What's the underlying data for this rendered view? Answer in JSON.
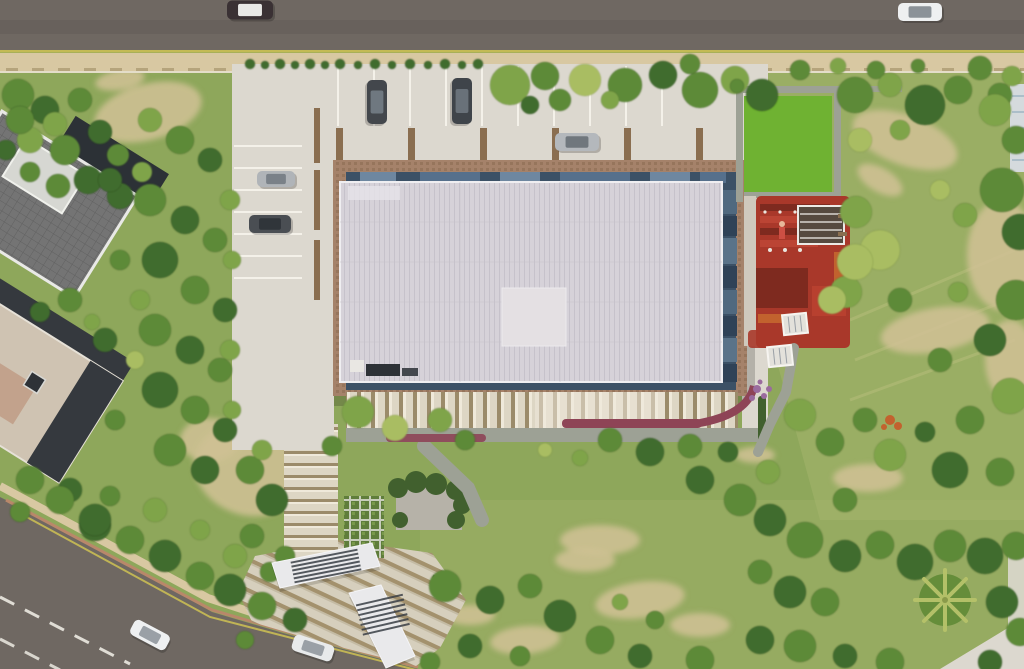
{
  "scene": {
    "view": "top-down aerial 3D architectural rendering of a site plan",
    "site": {
      "main_building": "rectangular hall with translucent ribbed light roof, dark blue glass clerestory and terracotta paved apron band",
      "parking": "stall rows north and west of the building with planter dividers",
      "playground": "red, maroon and orange play area east of the building beside a bright lawn",
      "entrance": "striped pedestrian axis with two white angular canopies at the south-west"
    },
    "roads": {
      "north": "straight asphalt road across full width with tan dashed sidewalk",
      "south_west": "diagonal asphalt road with dashed white centerline and yellow edge line"
    },
    "neighbors": [
      "dark gridded flat-roof building (north-west)",
      "beige flat-roof building (west)",
      "building corner at the east edge"
    ],
    "vegetation": [
      "street shrub row",
      "dense tree belts",
      "bright green lawn",
      "dry meadow with dirt patches",
      "palm tree (south-east)"
    ],
    "vehicle_count": 9
  },
  "colors": {
    "grass_base": "#8ea75b",
    "grass_light": "#a6b56d",
    "grass_pale": "#bcc17e",
    "lawn_green": "#6fb232",
    "dirt": "#cfc094",
    "gravel": "#b6b2a8",
    "road_asphalt": "#6f6862",
    "road_line_yellow": "#c9bd54",
    "road_line_white": "#eceae2",
    "curb_red": "#b9886a",
    "sidewalk_tan": "#d8c8a2",
    "sidewalk_dash": "#b5a47c",
    "pavement": "#dcd8cf",
    "pavement_line": "#f4f1e9",
    "planter_brown": "#8a6e50",
    "path_gray": "#9da195",
    "building_band": "#a5826a",
    "glass_dark": "#3c5166",
    "glass_light": "#6e87a0",
    "glass_mid": "#56708c",
    "glass_panel_a": "#50697f",
    "glass_panel_b": "#2f4257",
    "glass_panel_c": "#5a7389",
    "roof_light": "#d6d2d9",
    "roof_stripe": "#c6c2cb",
    "roof_patch": "#e4e0e3",
    "roof_edge": "#efeef1",
    "pergola_cream": "#ddd6c4",
    "pergola_brown": "#9b8b6a",
    "pergola_white": "#efe9da",
    "plaza_cream": "#d6cfbd",
    "plaza_brown": "#a3916d",
    "plaza_light": "#c4bba4",
    "tree_dark": "#406c2e",
    "tree_mid": "#5d8a38",
    "tree_light": "#7fa44a",
    "tree_pale": "#a9bd62",
    "hedge_dark": "#41602e",
    "play_red": "#a9382a",
    "play_maroon": "#7e2a1f",
    "play_orange": "#c2622e",
    "play_red_bright": "#bb4434",
    "canopy_white": "#e9e9eb",
    "canopy_louver": "#3a3f46",
    "flower_purple": "#9a6b9e",
    "flower_red": "#8e4456",
    "roofA_gray": "#747474",
    "roofA_line": "#616161",
    "roofA_dark": "#2c3136",
    "roofA_edge": "#e9e9e6",
    "roofB_beige": "#cfc3b2",
    "roofB_dark": "#35393e",
    "roofB_pink": "#c2a28c",
    "neighbor_wall": "#d5dadd",
    "neighbor_edge": "#edeff0",
    "car_window": "#8b9298"
  },
  "vehicles": [
    {
      "name": "top-road-car-dark",
      "x": 250,
      "y": 10,
      "len": 46,
      "wid": 19,
      "angle": 0,
      "body": "#3a3134",
      "glass": "#e8e8e6"
    },
    {
      "name": "top-road-car-white",
      "x": 920,
      "y": 12,
      "len": 44,
      "wid": 18,
      "angle": 0,
      "body": "#eef0f1",
      "glass": "#8b9298"
    },
    {
      "name": "parking-car-dark-1",
      "x": 377,
      "y": 102,
      "len": 44,
      "wid": 20,
      "angle": 90,
      "body": "#43474c",
      "glass": "#6f7880"
    },
    {
      "name": "parking-car-dark-2",
      "x": 462,
      "y": 101,
      "len": 46,
      "wid": 20,
      "angle": 90,
      "body": "#3f444a",
      "glass": "#697179"
    },
    {
      "name": "parking-car-silver-1",
      "x": 577,
      "y": 142,
      "len": 44,
      "wid": 18,
      "angle": 0,
      "body": "#b4b8bc",
      "glass": "#70777d"
    },
    {
      "name": "parking-car-silver-2",
      "x": 276,
      "y": 179,
      "len": 38,
      "wid": 16,
      "angle": 0,
      "body": "#b0b4b8",
      "glass": "#7a8188"
    },
    {
      "name": "parking-car-dark-3",
      "x": 270,
      "y": 224,
      "len": 42,
      "wid": 18,
      "angle": 0,
      "body": "#4a4e53",
      "glass": "#30353a"
    },
    {
      "name": "bottom-road-car-white-1",
      "x": 150,
      "y": 635,
      "len": 40,
      "wid": 17,
      "angle": 28,
      "body": "#eef0f1",
      "glass": "#9aa0a6"
    },
    {
      "name": "bottom-road-car-white-2",
      "x": 313,
      "y": 648,
      "len": 42,
      "wid": 17,
      "angle": 18,
      "body": "#e8eaeb",
      "glass": "#9aa0a6"
    }
  ],
  "landscape": {
    "dirt_patches": [
      [
        148,
        112,
        55,
        28,
        -15
      ],
      [
        120,
        80,
        25,
        10,
        -10
      ],
      [
        248,
        470,
        55,
        45,
        20
      ],
      [
        210,
        440,
        30,
        22,
        0
      ],
      [
        905,
        140,
        55,
        25,
        20
      ],
      [
        1002,
        255,
        35,
        55,
        0
      ],
      [
        935,
        330,
        55,
        22,
        -10
      ],
      [
        868,
        478,
        35,
        14,
        0
      ],
      [
        1010,
        360,
        25,
        40,
        0
      ],
      [
        880,
        180,
        25,
        12,
        30
      ],
      [
        640,
        600,
        45,
        18,
        -8
      ],
      [
        525,
        640,
        35,
        14,
        -5
      ],
      [
        470,
        615,
        25,
        10,
        0
      ],
      [
        700,
        625,
        30,
        12,
        0
      ],
      [
        600,
        540,
        40,
        15,
        0
      ],
      [
        585,
        560,
        30,
        12,
        0
      ],
      [
        755,
        455,
        20,
        8,
        0
      ]
    ],
    "trees": [
      [
        18,
        95,
        16,
        2
      ],
      [
        45,
        110,
        14,
        1
      ],
      [
        80,
        100,
        12,
        2
      ],
      [
        30,
        140,
        13,
        3
      ],
      [
        65,
        150,
        15,
        2
      ],
      [
        100,
        132,
        12,
        1
      ],
      [
        118,
        155,
        11,
        2
      ],
      [
        88,
        180,
        14,
        1
      ],
      [
        58,
        186,
        12,
        2
      ],
      [
        120,
        196,
        13,
        1
      ],
      [
        142,
        172,
        10,
        3
      ],
      [
        30,
        172,
        10,
        2
      ],
      [
        20,
        120,
        14,
        2
      ],
      [
        55,
        124,
        12,
        3
      ],
      [
        6,
        150,
        10,
        1
      ],
      [
        150,
        120,
        12,
        3
      ],
      [
        180,
        140,
        14,
        2
      ],
      [
        210,
        160,
        12,
        1
      ],
      [
        150,
        200,
        16,
        2
      ],
      [
        185,
        220,
        14,
        1
      ],
      [
        215,
        240,
        12,
        2
      ],
      [
        160,
        260,
        18,
        1
      ],
      [
        195,
        290,
        14,
        2
      ],
      [
        225,
        310,
        12,
        1
      ],
      [
        155,
        330,
        16,
        2
      ],
      [
        190,
        350,
        14,
        1
      ],
      [
        220,
        370,
        12,
        2
      ],
      [
        160,
        390,
        18,
        1
      ],
      [
        195,
        410,
        14,
        2
      ],
      [
        225,
        430,
        12,
        1
      ],
      [
        170,
        450,
        16,
        2
      ],
      [
        205,
        470,
        14,
        1
      ],
      [
        140,
        300,
        10,
        3
      ],
      [
        135,
        360,
        9,
        4
      ],
      [
        230,
        200,
        10,
        3
      ],
      [
        232,
        260,
        9,
        3
      ],
      [
        230,
        350,
        10,
        3
      ],
      [
        232,
        410,
        9,
        3
      ],
      [
        110,
        180,
        12,
        1
      ],
      [
        120,
        260,
        10,
        2
      ],
      [
        105,
        340,
        12,
        1
      ],
      [
        115,
        420,
        10,
        2
      ],
      [
        70,
        300,
        12,
        2
      ],
      [
        40,
        312,
        10,
        1
      ],
      [
        92,
        322,
        8,
        3
      ],
      [
        30,
        480,
        14,
        2
      ],
      [
        70,
        490,
        12,
        1
      ],
      [
        20,
        512,
        10,
        2
      ],
      [
        95,
        525,
        16,
        1
      ],
      [
        250,
        64,
        5,
        1
      ],
      [
        265,
        65,
        4,
        1
      ],
      [
        280,
        64,
        5,
        1
      ],
      [
        295,
        65,
        4,
        1
      ],
      [
        310,
        64,
        5,
        1
      ],
      [
        325,
        65,
        4,
        1
      ],
      [
        340,
        64,
        5,
        1
      ],
      [
        358,
        65,
        4,
        1
      ],
      [
        375,
        64,
        5,
        1
      ],
      [
        392,
        65,
        4,
        1
      ],
      [
        410,
        64,
        5,
        1
      ],
      [
        428,
        65,
        4,
        1
      ],
      [
        445,
        64,
        5,
        1
      ],
      [
        462,
        65,
        4,
        1
      ],
      [
        478,
        64,
        5,
        1
      ],
      [
        510,
        85,
        20,
        3
      ],
      [
        545,
        76,
        14,
        2
      ],
      [
        585,
        80,
        16,
        4
      ],
      [
        625,
        85,
        17,
        2
      ],
      [
        663,
        75,
        14,
        1
      ],
      [
        700,
        90,
        18,
        2
      ],
      [
        735,
        80,
        14,
        3
      ],
      [
        762,
        95,
        16,
        1
      ],
      [
        690,
        64,
        10,
        2
      ],
      [
        560,
        100,
        11,
        2
      ],
      [
        530,
        105,
        9,
        1
      ],
      [
        610,
        100,
        9,
        3
      ],
      [
        800,
        70,
        10,
        2
      ],
      [
        838,
        66,
        8,
        3
      ],
      [
        876,
        70,
        9,
        2
      ],
      [
        918,
        66,
        7,
        2
      ],
      [
        980,
        68,
        12,
        2
      ],
      [
        1012,
        76,
        10,
        3
      ],
      [
        1000,
        95,
        12,
        2
      ],
      [
        855,
        95,
        18,
        2
      ],
      [
        890,
        85,
        12,
        3
      ],
      [
        925,
        105,
        20,
        1
      ],
      [
        958,
        90,
        14,
        2
      ],
      [
        995,
        110,
        16,
        3
      ],
      [
        1016,
        140,
        14,
        2
      ],
      [
        860,
        140,
        12,
        4
      ],
      [
        900,
        130,
        10,
        3
      ],
      [
        1002,
        190,
        22,
        2
      ],
      [
        1020,
        232,
        18,
        1
      ],
      [
        965,
        215,
        12,
        3
      ],
      [
        940,
        190,
        10,
        4
      ],
      [
        856,
        212,
        16,
        3
      ],
      [
        880,
        250,
        20,
        4
      ],
      [
        846,
        292,
        16,
        3
      ],
      [
        900,
        300,
        12,
        2
      ],
      [
        958,
        292,
        10,
        3
      ],
      [
        1016,
        300,
        20,
        2
      ],
      [
        990,
        340,
        16,
        1
      ],
      [
        940,
        360,
        12,
        2
      ],
      [
        1010,
        396,
        18,
        3
      ],
      [
        970,
        420,
        14,
        2
      ],
      [
        925,
        432,
        10,
        1
      ],
      [
        865,
        420,
        12,
        2
      ],
      [
        890,
        455,
        16,
        3
      ],
      [
        950,
        470,
        18,
        1
      ],
      [
        1000,
        472,
        14,
        2
      ],
      [
        845,
        500,
        12,
        2
      ],
      [
        855,
        262,
        18,
        4
      ],
      [
        832,
        300,
        14,
        4
      ],
      [
        800,
        415,
        16,
        3
      ],
      [
        830,
        442,
        14,
        2
      ],
      [
        768,
        472,
        12,
        3
      ],
      [
        740,
        500,
        16,
        2
      ],
      [
        700,
        480,
        14,
        1
      ],
      [
        770,
        520,
        16,
        1
      ],
      [
        805,
        540,
        18,
        2
      ],
      [
        845,
        556,
        16,
        1
      ],
      [
        880,
        545,
        14,
        2
      ],
      [
        915,
        562,
        18,
        1
      ],
      [
        950,
        546,
        16,
        2
      ],
      [
        985,
        556,
        18,
        1
      ],
      [
        1016,
        546,
        14,
        2
      ],
      [
        760,
        572,
        12,
        2
      ],
      [
        790,
        592,
        16,
        1
      ],
      [
        825,
        602,
        14,
        2
      ],
      [
        1002,
        602,
        16,
        1
      ],
      [
        1020,
        632,
        14,
        2
      ],
      [
        760,
        640,
        14,
        1
      ],
      [
        800,
        646,
        16,
        2
      ],
      [
        845,
        656,
        12,
        1
      ],
      [
        890,
        662,
        14,
        2
      ],
      [
        990,
        662,
        12,
        1
      ],
      [
        445,
        586,
        16,
        2
      ],
      [
        490,
        600,
        14,
        1
      ],
      [
        530,
        586,
        12,
        2
      ],
      [
        560,
        616,
        16,
        1
      ],
      [
        600,
        640,
        14,
        2
      ],
      [
        640,
        656,
        12,
        1
      ],
      [
        700,
        660,
        14,
        2
      ],
      [
        520,
        656,
        10,
        2
      ],
      [
        470,
        646,
        12,
        1
      ],
      [
        430,
        662,
        10,
        2
      ],
      [
        620,
        602,
        8,
        3
      ],
      [
        655,
        620,
        9,
        2
      ],
      [
        60,
        500,
        14,
        2
      ],
      [
        95,
        520,
        16,
        1
      ],
      [
        130,
        540,
        14,
        2
      ],
      [
        165,
        556,
        16,
        1
      ],
      [
        200,
        576,
        14,
        2
      ],
      [
        230,
        590,
        16,
        1
      ],
      [
        262,
        606,
        14,
        2
      ],
      [
        235,
        556,
        12,
        3
      ],
      [
        200,
        530,
        10,
        3
      ],
      [
        155,
        510,
        12,
        3
      ],
      [
        110,
        496,
        10,
        2
      ],
      [
        295,
        620,
        12,
        1
      ],
      [
        270,
        572,
        10,
        2
      ],
      [
        245,
        640,
        9,
        2
      ],
      [
        250,
        470,
        14,
        2
      ],
      [
        272,
        500,
        16,
        1
      ],
      [
        252,
        536,
        12,
        2
      ],
      [
        285,
        556,
        10,
        2
      ],
      [
        262,
        450,
        10,
        3
      ],
      [
        358,
        412,
        16,
        3
      ],
      [
        395,
        428,
        13,
        4
      ],
      [
        332,
        446,
        10,
        2
      ],
      [
        440,
        420,
        12,
        3
      ],
      [
        465,
        440,
        10,
        2
      ],
      [
        610,
        440,
        12,
        2
      ],
      [
        650,
        452,
        14,
        1
      ],
      [
        690,
        446,
        12,
        2
      ],
      [
        728,
        452,
        10,
        1
      ],
      [
        580,
        458,
        8,
        3
      ],
      [
        545,
        450,
        7,
        4
      ],
      [
        737,
        86,
        7,
        2
      ]
    ]
  }
}
